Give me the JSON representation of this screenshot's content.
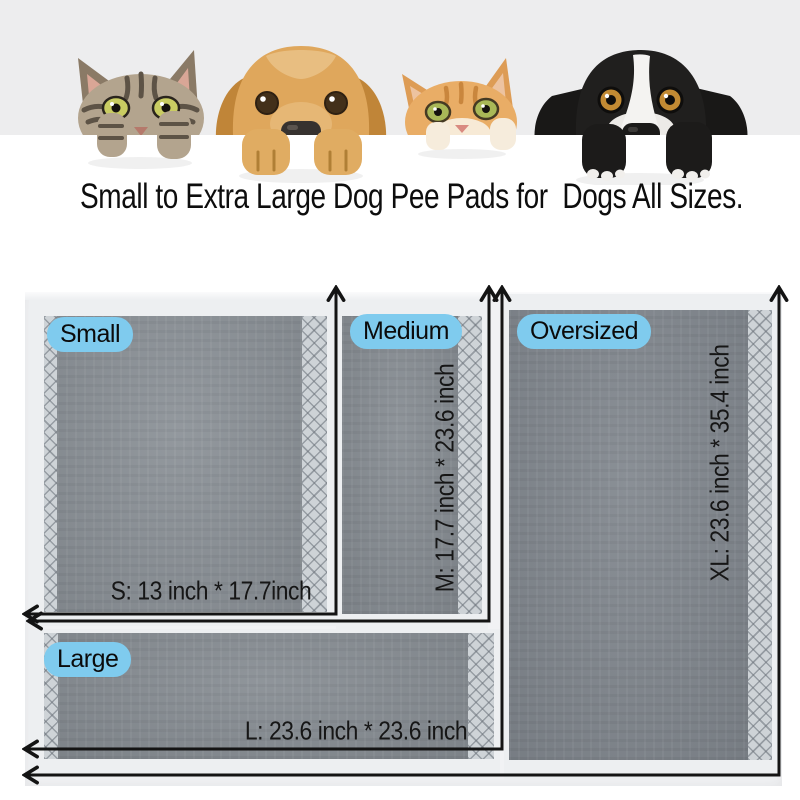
{
  "product_banner": {
    "headline": "Small to Extra Large Dog Pee Pads for  Dogs All Sizes.",
    "animals": [
      {
        "name": "tabby-cat"
      },
      {
        "name": "golden-retriever-dog"
      },
      {
        "name": "orange-tabby-cat"
      },
      {
        "name": "black-and-white-dog"
      }
    ]
  },
  "size_diagram": {
    "pads": [
      {
        "size_label": "Small",
        "dimension_text": "S: 13 inch * 17.7inch",
        "size_code": "S",
        "width_inch": 13,
        "height_inch": 17.7
      },
      {
        "size_label": "Medium",
        "dimension_text": "M: 17.7 inch * 23.6 inch",
        "size_code": "M",
        "width_inch": 17.7,
        "height_inch": 23.6
      },
      {
        "size_label": "Oversized",
        "dimension_text": "XL: 23.6 inch * 35.4 inch",
        "size_code": "XL",
        "width_inch": 23.6,
        "height_inch": 35.4
      },
      {
        "size_label": "Large",
        "dimension_text": "L: 23.6 inch * 23.6 inch",
        "size_code": "L",
        "width_inch": 23.6,
        "height_inch": 23.6
      }
    ],
    "colors": {
      "label_pill_bg": "#7fcbee",
      "pad_surface": "#878d93",
      "pad_edge_hatch": "#ced3d7",
      "sheet_bg": "#f1f2f4",
      "dimension_line": "#141414",
      "header_strip_bg": "#ededee"
    }
  }
}
